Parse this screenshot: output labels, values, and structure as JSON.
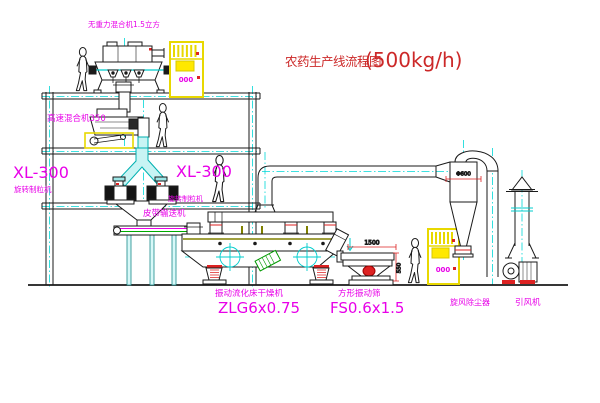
{
  "title": {
    "text": "农药生产线流程图",
    "capacity": "(500kg/h)"
  },
  "equipment_labels": {
    "gravity_free_mixer": "无重力混合机1.5立方",
    "high_speed_mixer": "高速混合机350",
    "granulator_left_model": "XL-300",
    "granulator_left_name": "旋转制粒机",
    "granulator_center_model": "XL-300",
    "granulator_center_name": "旋转制粒机",
    "belt_conveyor": "皮带输送机",
    "fluid_bed_dryer_name": "振动流化床干燥机",
    "fluid_bed_dryer_model": "ZLG6x0.75",
    "vibrating_sieve_name": "方形振动筛",
    "vibrating_sieve_model": "FS0.6x1.5",
    "cyclone_dust_collector": "旋风除尘器",
    "induced_draft_fan": "引风机"
  },
  "dimensions": {
    "sieve_length": "1500",
    "sieve_height": "550",
    "cyclone_diameter": "Φ600",
    "cabinet1_panel": "000",
    "cabinet2_panel": "000"
  },
  "colors": {
    "line_black": "#1a1a1a",
    "centerline_cyan": "#00d8d8",
    "label_magenta": "#e800e8",
    "title_red": "#cc2828",
    "dimension_red": "#dd2222",
    "cabinet_yellow": "#e8d800",
    "machine_olive": "#808000",
    "motor_green": "#009900"
  }
}
